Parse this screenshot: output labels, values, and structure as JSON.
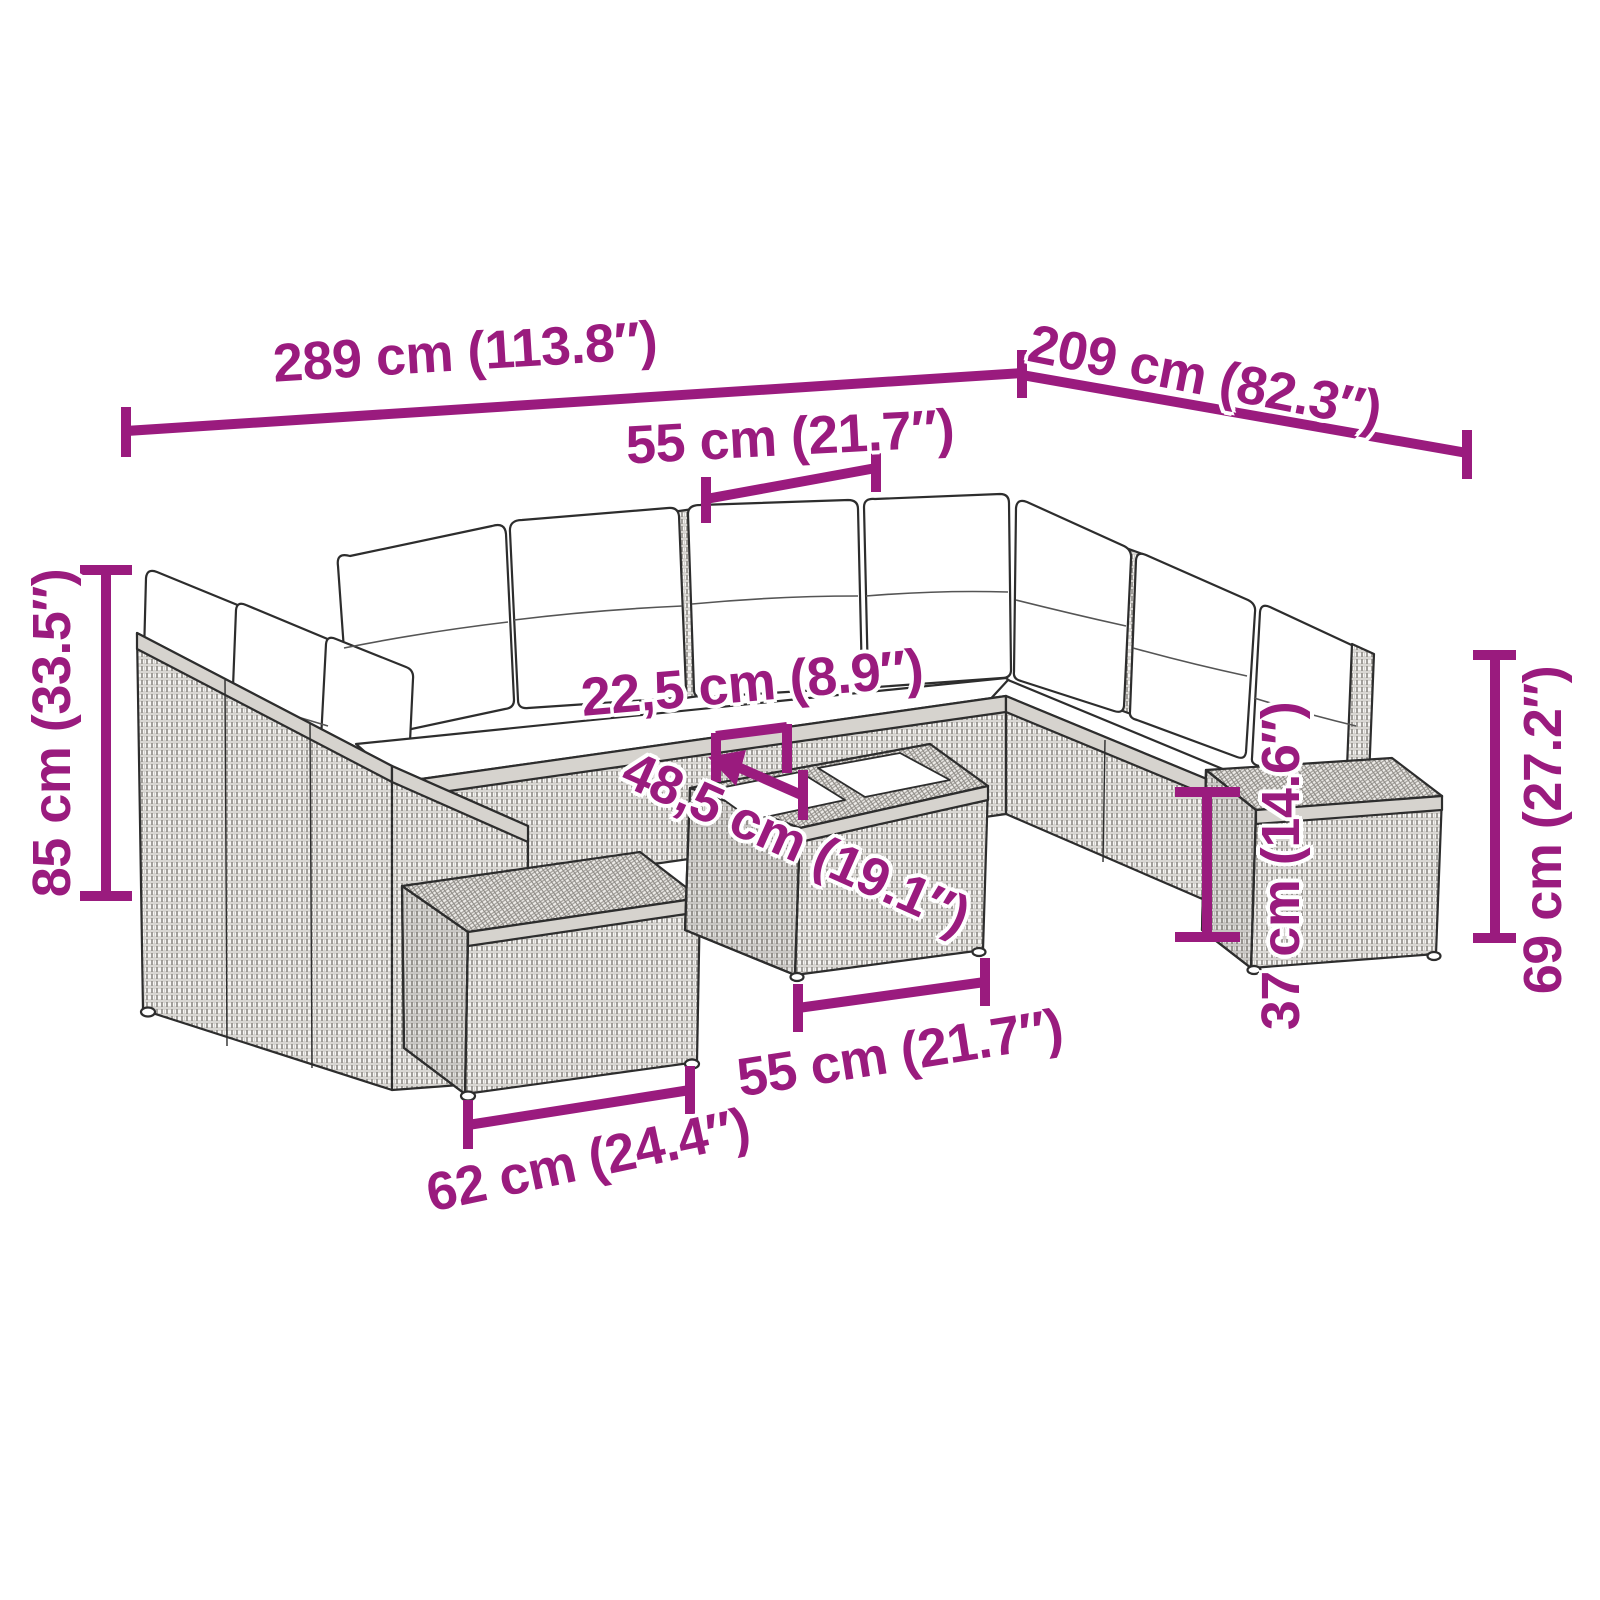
{
  "accent_color": "#9A1B7E",
  "dimensions": {
    "total_width": "289 cm (113.8″)",
    "total_depth": "209 cm (82.3″)",
    "seat_width": "55 cm (21.7″)",
    "total_height": "85 cm (33.5″)",
    "seat_table_gap": "22,5 cm (8.9″)",
    "table_depth": "48,5 cm (19.1″)",
    "table_width": "55 cm (21.7″)",
    "ottoman_width": "62 cm (24.4″)",
    "seat_height": "37 cm (14.6″)",
    "armrest_height": "69 cm (27.2″)"
  }
}
